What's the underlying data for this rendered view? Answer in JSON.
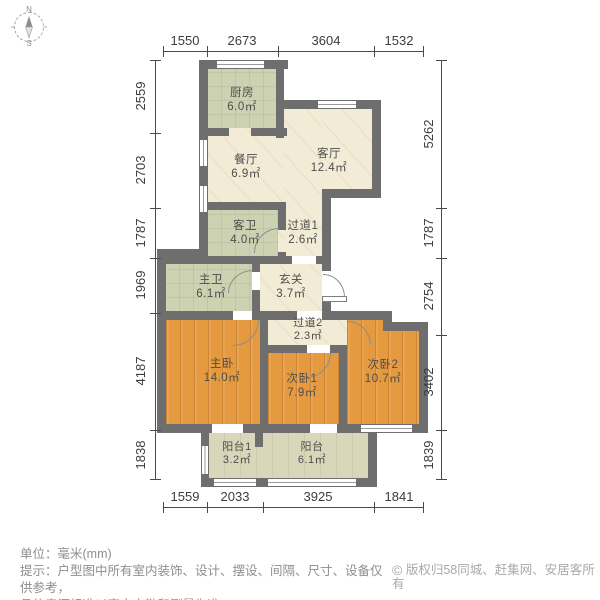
{
  "compass": {
    "north": "N",
    "south": "S"
  },
  "dimensions": {
    "unit": "mm",
    "top": [
      "1550",
      "2673",
      "3604",
      "1532"
    ],
    "left": [
      "2559",
      "2703",
      "1787",
      "1969",
      "4187",
      "1838"
    ],
    "right": [
      "5262",
      "1787",
      "2754",
      "3402",
      "1839"
    ],
    "bottom": [
      "1559",
      "2033",
      "3925",
      "1841"
    ]
  },
  "rooms": [
    {
      "name": "厨房",
      "area": "6.0㎡"
    },
    {
      "name": "餐厅",
      "area": "6.9㎡"
    },
    {
      "name": "客厅",
      "area": "12.4㎡"
    },
    {
      "name": "客卫",
      "area": "4.0㎡"
    },
    {
      "name": "过道1",
      "area": "2.6㎡"
    },
    {
      "name": "主卫",
      "area": "6.1㎡"
    },
    {
      "name": "玄关",
      "area": "3.7㎡"
    },
    {
      "name": "过道2",
      "area": "2.3㎡"
    },
    {
      "name": "主卧",
      "area": "14.0㎡"
    },
    {
      "name": "次卧1",
      "area": "7.9㎡"
    },
    {
      "name": "次卧2",
      "area": "10.7㎡"
    },
    {
      "name": "阳台1",
      "area": "3.2㎡"
    },
    {
      "name": "阳台",
      "area": "6.1㎡"
    }
  ],
  "footer": {
    "unit_line": "单位：毫米(mm)",
    "tip_line1": "提示：户型图中所有室内装饰、设计、摆设、间隔、尺寸、设备仅供参考，",
    "tip_line2": "具体房源标准以室内查勘和测量为准。",
    "copyright_symbol": "©",
    "copyright": "版权归58同城、赶集网、安居客所有"
  },
  "colors": {
    "wall": "#6E6E6E",
    "wood_floor": "#E59A40",
    "tile_green": "#CCD2B2",
    "marble_beige": "#F2EBD6",
    "balcony_khaki": "#D9D6BA",
    "dimension_text": "#3C3C3C",
    "footer_text": "#8E8E8E"
  }
}
